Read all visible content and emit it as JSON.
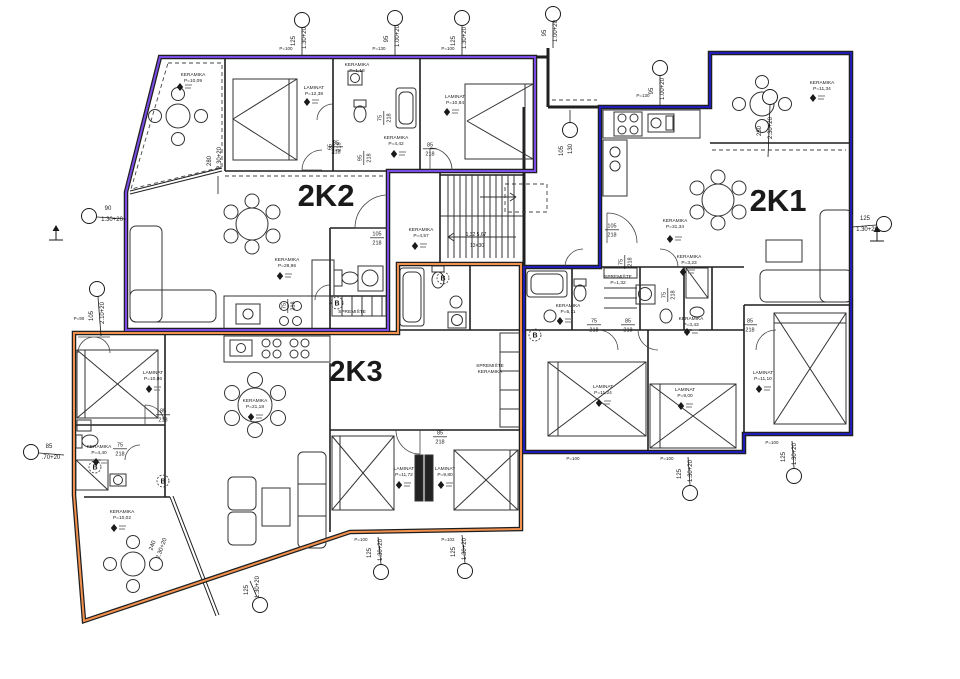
{
  "meta": {
    "title": "Floor plan – apartments 2K1 / 2K2 / 2K3",
    "width": 960,
    "height": 679
  },
  "units": [
    {
      "id": "2K1",
      "label": "2K1",
      "color": "#1f1cb8",
      "label_x": 778,
      "label_y": 211,
      "font": 31,
      "outline": "M600,107 H710 V53 H851 V434 H744 V452 H524 V267 H600 Z"
    },
    {
      "id": "2K2",
      "label": "2K2",
      "color": "#7b4ce6",
      "label_x": 326,
      "label_y": 206,
      "font": 31,
      "outline": "M160,57 H535 V171 H388 V330 H126 V192 Z"
    },
    {
      "id": "2K3",
      "label": "2K3",
      "color": "#f2914e",
      "label_x": 356,
      "label_y": 381,
      "font": 29,
      "outline": "M74,333 H398 V264 H521 V529 L350,532 L84,621 L74,495 Z"
    }
  ],
  "room_labels": [
    {
      "n": "KERAMIKA",
      "a": "P=10,09",
      "x": 193,
      "y": 76,
      "dx": 180,
      "dy": 87
    },
    {
      "n": "LAMINAT",
      "a": "P=12,38",
      "x": 314,
      "y": 89,
      "dx": 307,
      "dy": 102
    },
    {
      "n": "KERAMIKA",
      "a": "P=1,18",
      "x": 357,
      "y": 66
    },
    {
      "n": "LAMINAT",
      "a": "P=10,84",
      "x": 455,
      "y": 98,
      "dx": 447,
      "dy": 112
    },
    {
      "n": "KERAMIKA",
      "a": "P=4,42",
      "x": 396,
      "y": 139,
      "dx": 394,
      "dy": 154
    },
    {
      "n": "KERAMIKA",
      "a": "P=28,96",
      "x": 287,
      "y": 261,
      "dx": 280,
      "dy": 276
    },
    {
      "n": "SPREMIŠTE",
      "a": "",
      "x": 352,
      "y": 313
    },
    {
      "n": "KERAMIKA",
      "a": "P=11,34",
      "x": 822,
      "y": 84,
      "dx": 813,
      "dy": 98
    },
    {
      "n": "KERAMIKA",
      "a": "P=31,34",
      "x": 675,
      "y": 222,
      "dx": 670,
      "dy": 239
    },
    {
      "n": "SPREMIŠTE",
      "a": "P=1,32",
      "x": 618,
      "y": 278
    },
    {
      "n": "KERAMIKA",
      "a": "P=3,23",
      "x": 689,
      "y": 258,
      "dx": 683,
      "dy": 272
    },
    {
      "n": "KERAMIKA",
      "a": "P=5,11",
      "x": 568,
      "y": 307,
      "dx": 560,
      "dy": 321
    },
    {
      "n": "KERAMIKA",
      "a": "P=3,43",
      "x": 691,
      "y": 320,
      "dx": 687,
      "dy": 332
    },
    {
      "n": "LAMINAT",
      "a": "P=11,24",
      "x": 603,
      "y": 388,
      "dx": 599,
      "dy": 403
    },
    {
      "n": "LAMINAT",
      "a": "P=9,00",
      "x": 685,
      "y": 391,
      "dx": 681,
      "dy": 406
    },
    {
      "n": "LAMINAT",
      "a": "P=11,10",
      "x": 763,
      "y": 374,
      "dx": 759,
      "dy": 389
    },
    {
      "n": "LAMINAT",
      "a": "P=10,86",
      "x": 153,
      "y": 374,
      "dx": 149,
      "dy": 389
    },
    {
      "n": "KERAMIKA",
      "a": "P=4,40",
      "x": 99,
      "y": 448,
      "dx": 96,
      "dy": 462
    },
    {
      "n": "KERAMIKA",
      "a": "P=10,02",
      "x": 122,
      "y": 513,
      "dx": 114,
      "dy": 528
    },
    {
      "n": "KERAMIKA",
      "a": "P=21,18",
      "x": 255,
      "y": 402,
      "dx": 251,
      "dy": 417
    },
    {
      "n": "KERAMIKA",
      "a": "P=4,57",
      "x": 421,
      "y": 231,
      "dx": 415,
      "dy": 246
    },
    {
      "n": "LAMINAT",
      "a": "P=11,72",
      "x": 404,
      "y": 470,
      "dx": 399,
      "dy": 485
    },
    {
      "n": "LAMINAT",
      "a": "P=9,80",
      "x": 445,
      "y": 470,
      "dx": 441,
      "dy": 485
    },
    {
      "n": "SPREMIŠTE",
      "a": "KERAMIKA",
      "x": 490,
      "y": 367
    }
  ],
  "door_labels": [
    [
      "85",
      "218",
      336,
      146,
      0
    ],
    [
      "95",
      "218",
      363,
      158,
      -90
    ],
    [
      "75",
      "218",
      383,
      118,
      -90
    ],
    [
      "65",
      "218",
      333,
      147,
      -90
    ],
    [
      "85",
      "218",
      430,
      148,
      0
    ],
    [
      "105",
      "218",
      377,
      237,
      0
    ],
    [
      "75",
      "218",
      287,
      306,
      -90
    ],
    [
      "105",
      "218",
      612,
      229,
      0
    ],
    [
      "75",
      "218",
      624,
      262,
      -90
    ],
    [
      "75",
      "218",
      594,
      324,
      0
    ],
    [
      "85",
      "218",
      628,
      324,
      0
    ],
    [
      "85",
      "218",
      750,
      324,
      0
    ],
    [
      "75",
      "218",
      667,
      295,
      -90
    ],
    [
      "85",
      "218",
      163,
      414,
      0
    ],
    [
      "75",
      "218",
      120,
      448,
      0
    ],
    [
      "85",
      "218",
      440,
      436,
      0
    ]
  ],
  "window_markers": [
    {
      "c": [
        302,
        20
      ],
      "l": [
        302,
        28,
        302,
        55
      ],
      "t": [
        [
          "125",
          295,
          41,
          -90
        ],
        [
          "1.30+20",
          306,
          38,
          -90
        ]
      ]
    },
    {
      "c": [
        395,
        18
      ],
      "l": [
        395,
        26,
        395,
        55
      ],
      "t": [
        [
          "95",
          388,
          39,
          -90
        ],
        [
          "1.00+20",
          399,
          36,
          -90
        ]
      ]
    },
    {
      "c": [
        462,
        18
      ],
      "l": [
        462,
        26,
        462,
        55
      ],
      "t": [
        [
          "125",
          455,
          41,
          -90
        ],
        [
          "1.30+20",
          466,
          38,
          -90
        ]
      ]
    },
    {
      "c": [
        553,
        14
      ],
      "l": [
        553,
        22,
        553,
        48
      ],
      "t": [
        [
          "95",
          546,
          33,
          -90
        ],
        [
          "1.00+20",
          557,
          31,
          -90
        ]
      ]
    },
    {
      "c": [
        660,
        68
      ],
      "l": [
        660,
        76,
        660,
        105
      ],
      "t": [
        [
          "95",
          653,
          91,
          -90
        ],
        [
          "1.00+20",
          664,
          89,
          -90
        ]
      ]
    },
    {
      "c": [
        89,
        216
      ],
      "l": [
        97,
        217,
        126,
        219
      ],
      "t": [
        [
          "90",
          108,
          210,
          0
        ],
        [
          "1.30+20",
          112,
          221,
          0
        ]
      ]
    },
    {
      "c": [
        97,
        289
      ],
      "l": [
        98,
        297,
        101,
        336
      ],
      "t": [
        [
          "105",
          93,
          316,
          -90
        ],
        [
          "2.10+20",
          104,
          313,
          -90
        ]
      ]
    },
    {
      "c": [
        31,
        452
      ],
      "l": [
        39,
        453,
        64,
        455
      ],
      "t": [
        [
          "85",
          49,
          448,
          0
        ],
        [
          ".70+20",
          51,
          459,
          0
        ]
      ]
    },
    {
      "c": [
        884,
        224
      ],
      "l": [
        876,
        225,
        852,
        227
      ],
      "t": [
        [
          "125",
          865,
          220,
          0
        ],
        [
          "1.30+20",
          867,
          231,
          0
        ]
      ]
    },
    {
      "c": [
        260,
        605
      ],
      "l": [
        257,
        597,
        250,
        581
      ],
      "t": [
        [
          "125",
          248,
          590,
          -90
        ],
        [
          "1.30+20",
          259,
          587,
          -90
        ]
      ]
    },
    {
      "c": [
        381,
        572
      ],
      "l": [
        381,
        564,
        378,
        537
      ],
      "t": [
        [
          "125",
          371,
          553,
          -90
        ],
        [
          "1.30+20",
          382,
          550,
          -90
        ]
      ]
    },
    {
      "c": [
        465,
        571
      ],
      "l": [
        465,
        563,
        462,
        535
      ],
      "t": [
        [
          "125",
          455,
          552,
          -90
        ],
        [
          "1.30+20",
          466,
          549,
          -90
        ]
      ]
    },
    {
      "c": [
        690,
        493
      ],
      "l": [
        690,
        485,
        688,
        457
      ],
      "t": [
        [
          "125",
          681,
          474,
          -90
        ],
        [
          "1.30+20",
          692,
          471,
          -90
        ]
      ]
    },
    {
      "c": [
        794,
        476
      ],
      "l": [
        794,
        468,
        792,
        441
      ],
      "t": [
        [
          "125",
          785,
          457,
          -90
        ],
        [
          "1.30+20",
          796,
          454,
          -90
        ]
      ]
    },
    {
      "c": [
        770,
        97
      ],
      "l": [
        770,
        105,
        768,
        157
      ],
      "t": [
        [
          "280",
          761,
          131,
          -90
        ],
        [
          "2.30+20",
          772,
          128,
          -90
        ]
      ]
    },
    {
      "l": [
        218,
        176,
        218,
        194
      ],
      "t": [
        [
          "280",
          211,
          161,
          -90
        ],
        [
          "2.30+20",
          221,
          158,
          -90
        ]
      ]
    },
    {
      "c": [
        570,
        130
      ],
      "l": [
        570,
        122,
        570,
        110
      ],
      "t": [
        [
          "105",
          563,
          151,
          -90
        ],
        [
          "130",
          572,
          149,
          -90
        ]
      ]
    },
    {
      "t": [
        [
          "240",
          154,
          546,
          -70
        ],
        [
          "2.30+20",
          163,
          549,
          -70
        ]
      ]
    }
  ],
  "wall_labels": [
    [
      "P=100",
      286,
      50
    ],
    [
      "P=130",
      379,
      50
    ],
    [
      "P=100",
      448,
      50
    ],
    [
      "P=130",
      643,
      97
    ],
    [
      "P=90",
      79,
      320
    ],
    [
      "P=100",
      573,
      460
    ],
    [
      "P=100",
      667,
      460
    ],
    [
      "P=100",
      772,
      444
    ],
    [
      "P=100",
      361,
      541
    ],
    [
      "P=102",
      448,
      541
    ]
  ],
  "circled_marks": [
    {
      "t": "B",
      "x": 337,
      "y": 303
    },
    {
      "t": "B",
      "x": 95,
      "y": 467
    },
    {
      "t": "B",
      "x": 163,
      "y": 481
    },
    {
      "t": "B",
      "x": 443,
      "y": 278
    },
    {
      "t": "B",
      "x": 535,
      "y": 335
    }
  ],
  "stairs_texts": [
    [
      "1,32  5,67",
      476,
      236
    ],
    [
      "13×30",
      477,
      247
    ]
  ],
  "benchmarks": [
    [
      56,
      240
    ],
    [
      877,
      241
    ]
  ],
  "palette": {
    "wall": "#1f1f1f",
    "background": "#ffffff"
  }
}
